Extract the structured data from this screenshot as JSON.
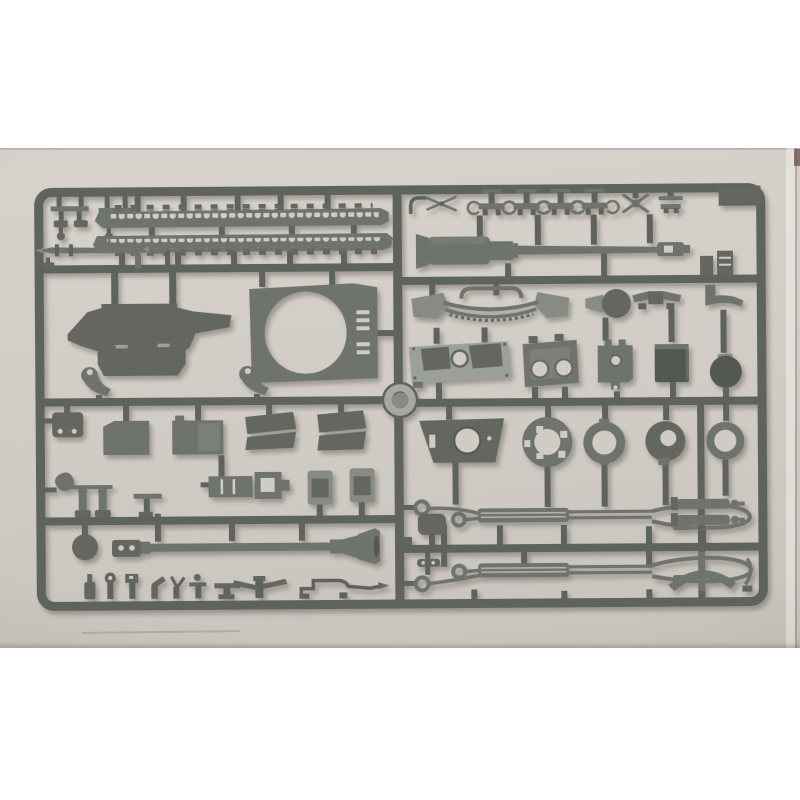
{
  "scene": {
    "type": "photograph",
    "subject": "grey plastic injection-moulded model-kit sprue with tank parts on a light grey backdrop",
    "layout": "landscape photo centered vertically on a white page, white margins above and below"
  },
  "colors": {
    "page_bg": "#ffffff",
    "photo_top": "#d7d3cc",
    "photo_mid": "#d0ccc5",
    "photo_bottom": "#c7c3bc",
    "runner": "#5f635e",
    "plastic_mid": "#6f736e",
    "plastic_mid_dark": "#636760",
    "plastic_dark": "#545853",
    "plastic_light": "#878b84",
    "plastic_pale": "#9ca09a",
    "plastic_gate": "#aaa79f",
    "edge_line": "#b3afa9"
  },
  "sprue": {
    "frame": "rounded rectangular runner frame with central vertical runner and injection gate disc at center",
    "center_part": "injection-gate-disc",
    "left_half_parts": [
      "corner-bracket-cluster-a",
      "corner-bracket-cluster-b",
      "track-run-upper",
      "track-run-lower",
      "cleaning-rod-with-elbow",
      "upper-hull-panel",
      "hull-roof-plate-with-turret-ring-opening",
      "grab-hook-a",
      "grab-hook-b",
      "stowage-box-small",
      "stowage-box-a",
      "stowage-box-b",
      "mudguard-pair-a",
      "mudguard-pair-b",
      "shovel-with-posts",
      "mount-bracket",
      "gun-cradle-coupling",
      "vision-port-a",
      "vision-port-b",
      "road-wheel-disc",
      "gun-barrel-lower-with-muzzle-brake",
      "fittings-row-bottle",
      "fittings-row-wheel-post",
      "fittings-row-cap-post",
      "fittings-row-lever",
      "fittings-row-fork",
      "fittings-row-tee-disc",
      "fittings-row-tee-bar",
      "fittings-row-winged-axle",
      "fittings-row-long-rod"
    ],
    "right_half_parts": [
      "elbow-pipe",
      "scissors-linkage",
      "clamp-bracket-1",
      "clamp-bracket-2",
      "clamp-bracket-3",
      "clamp-bracket-4",
      "cross-clamp",
      "end-bracket",
      "corner-block",
      "main-gun-barrel-with-muzzle-brake",
      "tow-box-a",
      "tow-box-b",
      "boot-bracket",
      "front-bumper-frame",
      "disc-cap-with-spike",
      "wing-bracket",
      "engine-grille-plate",
      "hatch-plate-twin-holes",
      "crenellated-mount-plate",
      "dark-stowage-box",
      "ball-mount",
      "turret-base-trapezoid-plate",
      "wheel-ring-large",
      "wheel-ring-medium",
      "wheel-hub-offset",
      "wheel-ring-small",
      "tow-cable-upper",
      "tow-cable-lower",
      "cable-pad",
      "cable-clasp",
      "small-block",
      "recoil-cylinder-pair",
      "pickaxe",
      "curved-bracket"
    ]
  }
}
